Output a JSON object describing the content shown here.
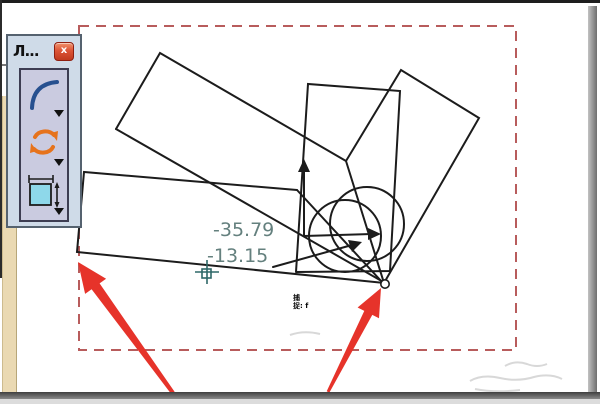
{
  "palette": {
    "title_glyph": "Л...",
    "close_glyph": "x",
    "tools": [
      {
        "icon": "arc-icon"
      },
      {
        "icon": "rotate-icon"
      },
      {
        "icon": "rect-dimension-icon"
      }
    ]
  },
  "canvas": {
    "coord_readout": {
      "x": "-35.79",
      "y": "-13.15"
    },
    "snap_hint": {
      "line1": "捕",
      "line2": "捉: f"
    }
  },
  "colors": {
    "selection_dash": "#b85c5c",
    "annotation_arrow": "#e6332a",
    "sketch_line": "#1c1c1c",
    "coord_text": "#64807e",
    "crosshair": "#2f6868"
  }
}
